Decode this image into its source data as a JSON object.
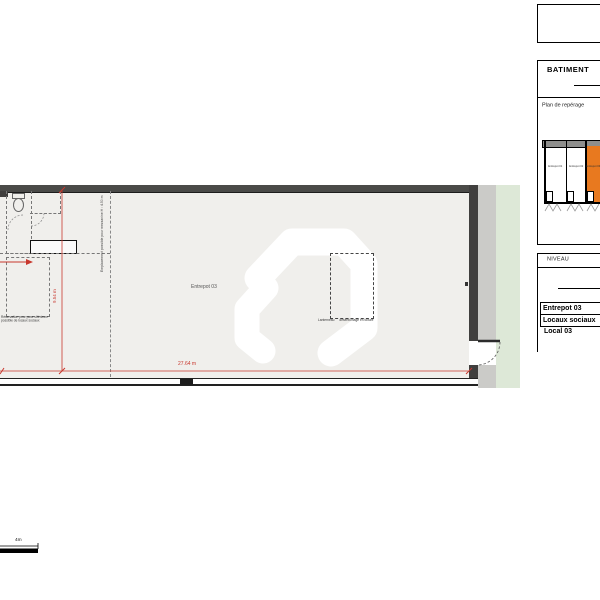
{
  "plan": {
    "room_label": "Entrepot 03",
    "width_dim": "27.64 m",
    "height_dim": "9.54 m",
    "reservation_note_line1": "Réservation pour pose ultérieure",
    "reservation_note_line2": "possible de locaux sociaux",
    "mezzanine_note": "Emplacement possible pour mezzanine H : 4.50 m",
    "skylight_label_left": "Lanterneau",
    "skylight_label_right": "désenfumage en toiture",
    "scale_label": "4m"
  },
  "panel": {
    "building_title": "BATIMENT",
    "location_plan_label": "Plan de repérage",
    "mini_plan_units": [
      "Entrepot 01",
      "Entrepot 02",
      "Entrepot 03"
    ],
    "level_label": "NIVEAU",
    "sheet_titles": [
      "Entrepot 03",
      "Locaux sociaux",
      "Local 03"
    ]
  },
  "colors": {
    "highlight_orange": "#e8791f",
    "dimension_red": "#c8372d",
    "exterior_green": "#dde8d7",
    "concrete_grey": "#cbcbc8",
    "wall_dark": "#464645",
    "floor_grey": "#f0efec"
  }
}
